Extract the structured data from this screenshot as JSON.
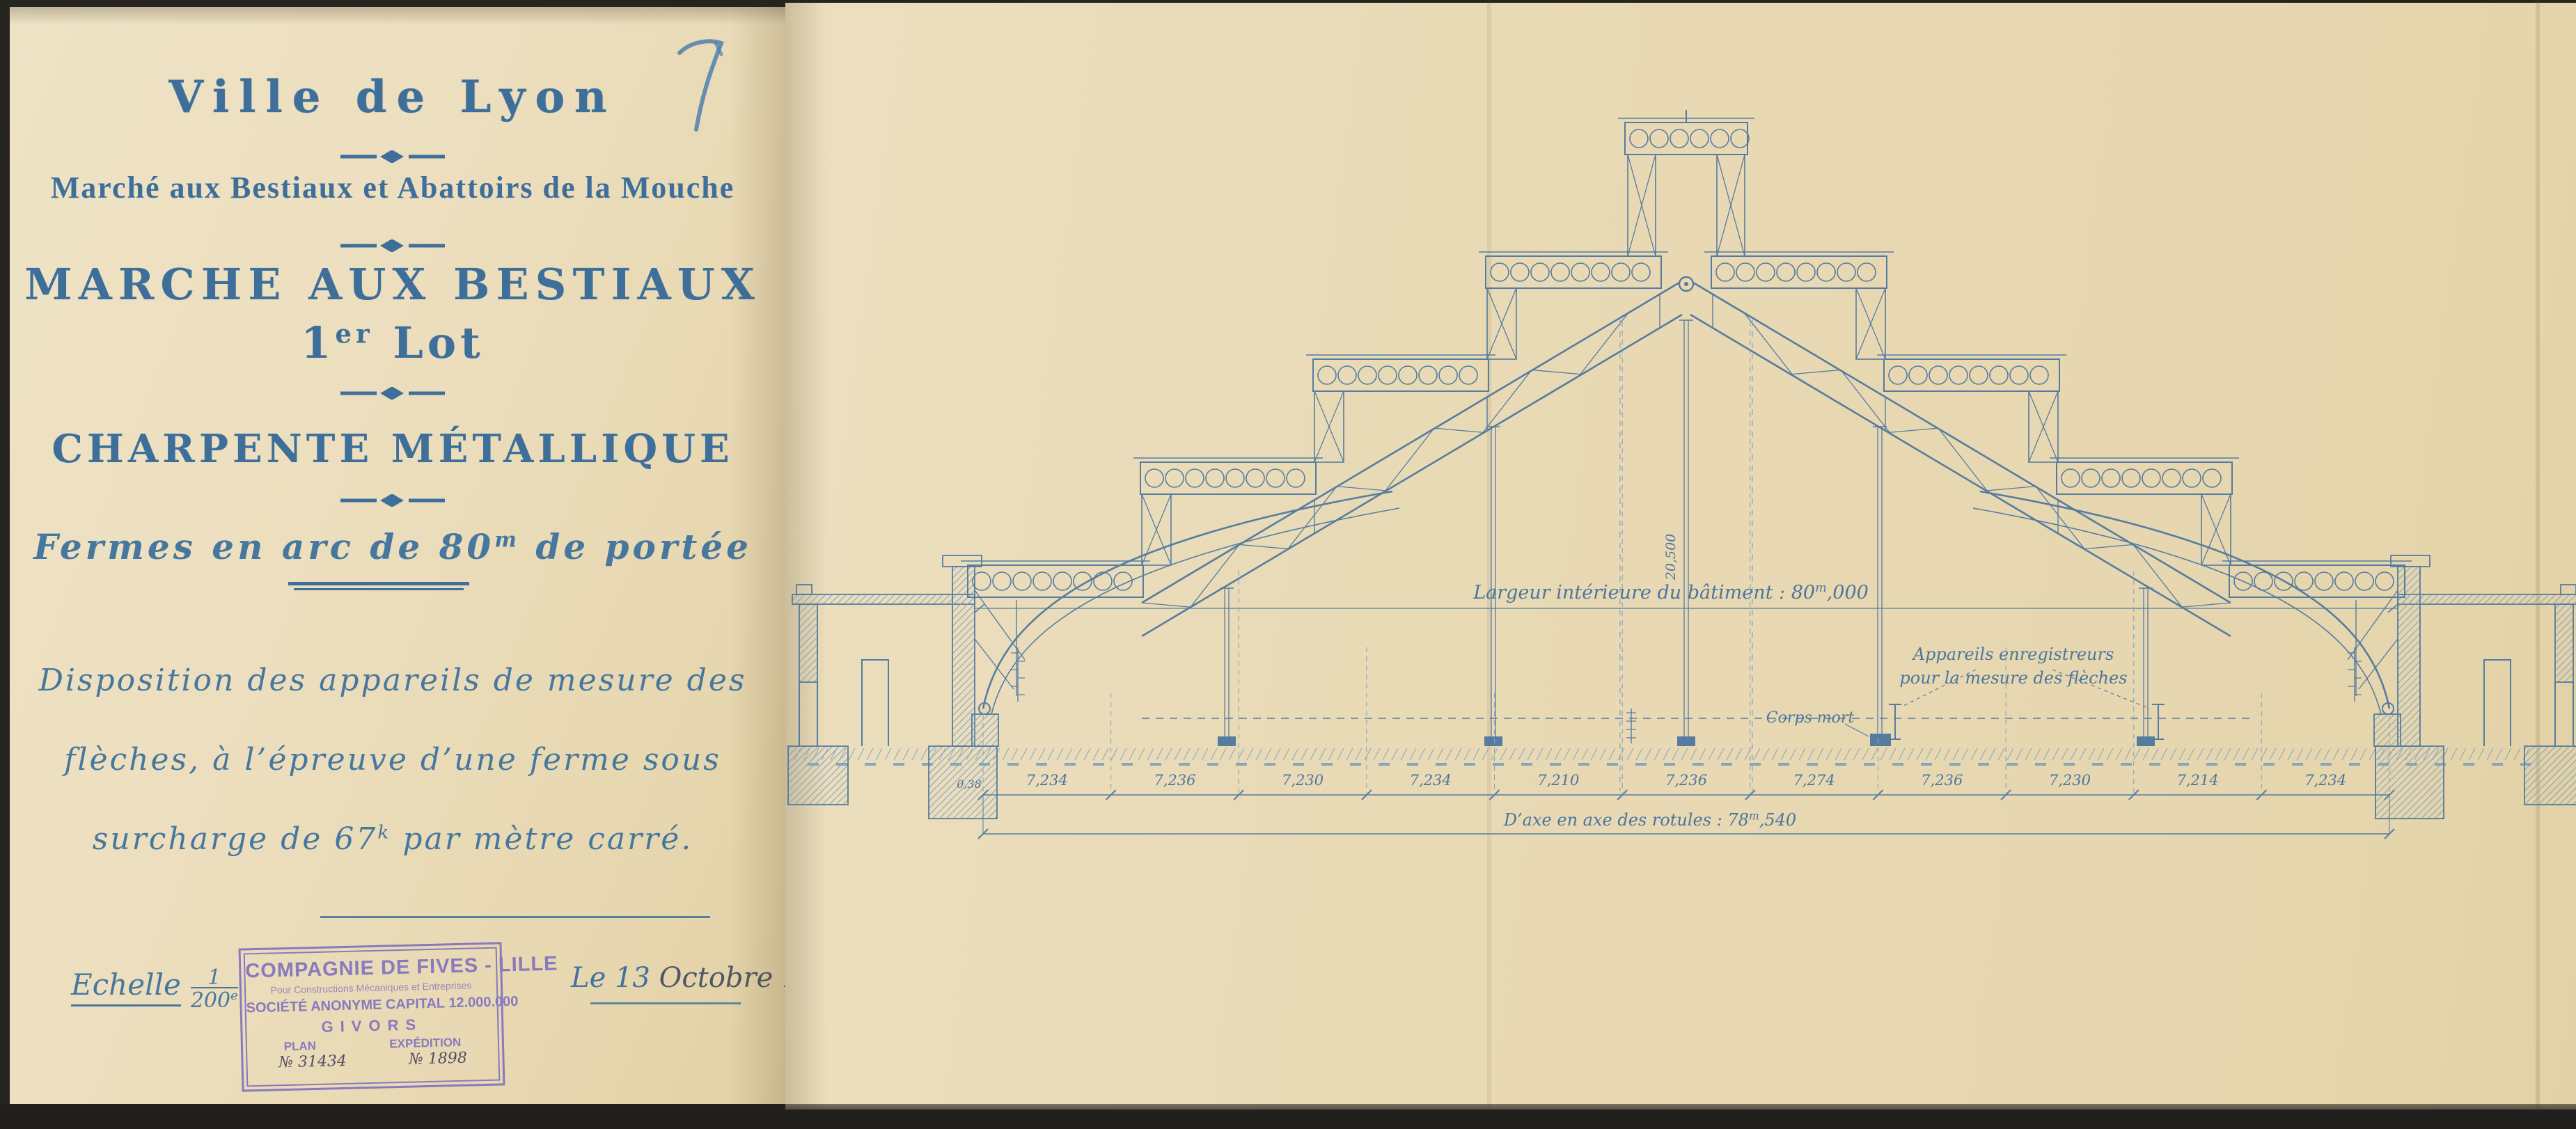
{
  "page_number": "7",
  "title_block": {
    "city": "Ville de Lyon",
    "subtitle": "Marché aux Bestiaux et Abattoirs de la Mouche",
    "project": "MARCHE AUX BESTIAUX",
    "lot_num": "1",
    "lot_sup": "er",
    "lot_word": " Lot",
    "section": "CHARPENTE MÉTALLIQUE",
    "fermes_pre": "Fermes en arc de 80",
    "fermes_sup": "m",
    "fermes_post": " de portée",
    "note_line1": "Disposition des appareils de mesure des",
    "note_line2": "flèches, à l’épreuve d’une ferme sous",
    "note_line3_pre": "surcharge de 67",
    "note_line3_sup": "k",
    "note_line3_post": " par mètre carré."
  },
  "scale_block": {
    "word": "Echelle",
    "num": "1",
    "den": "200",
    "den_sup": "e"
  },
  "date_block": {
    "d1": "Le 13",
    "d2": " Octobre ",
    "d3": "1913."
  },
  "stamp": {
    "line1": "COMPAGNIE DE FIVES - LILLE",
    "line2": "Pour Constructions Mécaniques et Entreprises",
    "line3": "SOCIÉTÉ ANONYME CAPITAL 12.000.000",
    "line4": "GIVORS",
    "plan_label": "PLAN",
    "plan_no": "№ 31434",
    "exp_label": "EXPÉDITION",
    "exp_no": "№ 1898"
  },
  "drawing": {
    "width_pre": "Largeur intérieure du bâtiment : 80",
    "width_sup": "m",
    "width_post": ",000",
    "apparatus_line1": "Appareils enregistreurs",
    "apparatus_line2": "pour la mesure des flèches",
    "corps_mort": "Corps mort",
    "height_label": "20,500",
    "small_dim": "0,38",
    "dim_values": [
      "7,234",
      "7,236",
      "7,230",
      "7,234",
      "7,210",
      "7,236",
      "7,274",
      "7,236",
      "7,230",
      "7,214",
      "7,234"
    ],
    "total_pre": "D’axe en axe des rotules : 78",
    "total_sup": "m",
    "total_post": ",540"
  },
  "colors": {
    "ink": "#3e6f9b",
    "ink2": "#46789f",
    "draw": "#4a769f",
    "drawlight": "#7ea2bf",
    "stamp": "#8474bf",
    "handpurple": "#4c4660",
    "hand": "#4d5864",
    "handblue": "#41719f",
    "pencil": "#4f80ae"
  }
}
